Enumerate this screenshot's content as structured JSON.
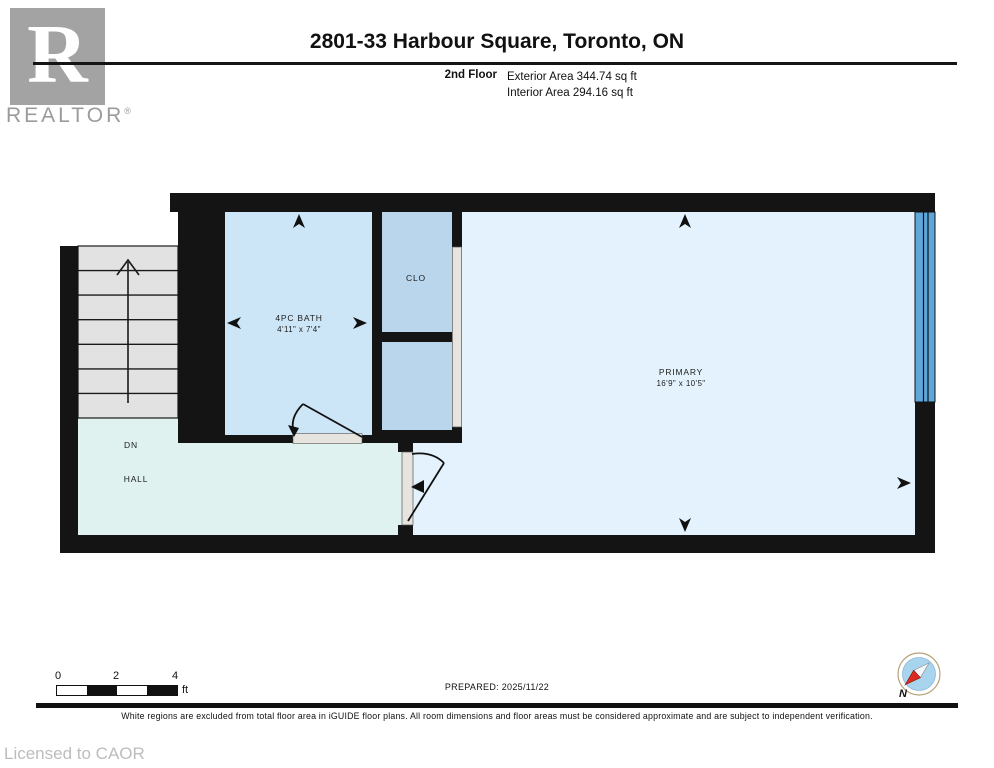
{
  "header": {
    "logo": {
      "letter": "R",
      "wordmark": "REALTOR",
      "reg": "®"
    },
    "title": "2801-33 Harbour Square, Toronto, ON",
    "floor_label": "2nd Floor",
    "exterior_area": "Exterior Area 344.74 sq ft",
    "interior_area": "Interior Area 294.16 sq ft"
  },
  "plan": {
    "rooms": {
      "bath": {
        "name": "4PC BATH",
        "dims": "4'11\" x 7'4\""
      },
      "closet": {
        "name": "CLO"
      },
      "primary": {
        "name": "PRIMARY",
        "dims": "16'9\" x 10'5\""
      },
      "hall": {
        "name": "HALL"
      },
      "stairs": {
        "label": "DN"
      }
    },
    "colors": {
      "wall": "#141414",
      "bath_fill": "#cde6f7",
      "closet_fill": "#b9d6ec",
      "primary_fill": "#e3f2fc",
      "hall_fill": "#dff2f0",
      "stairs_fill": "#e2e2e2",
      "window_fill": "#5ea7da",
      "door_fill": "#e7e4df"
    }
  },
  "footer": {
    "scale": {
      "t0": "0",
      "t2": "2",
      "t4": "4",
      "unit": "ft"
    },
    "prepared": "PREPARED: 2025/11/22",
    "compass_label": "N",
    "disclaimer": "White regions are excluded from total floor area in iGUIDE floor plans. All room dimensions and floor areas must be considered approximate and are subject to independent verification.",
    "licensed": "Licensed to CAOR"
  }
}
